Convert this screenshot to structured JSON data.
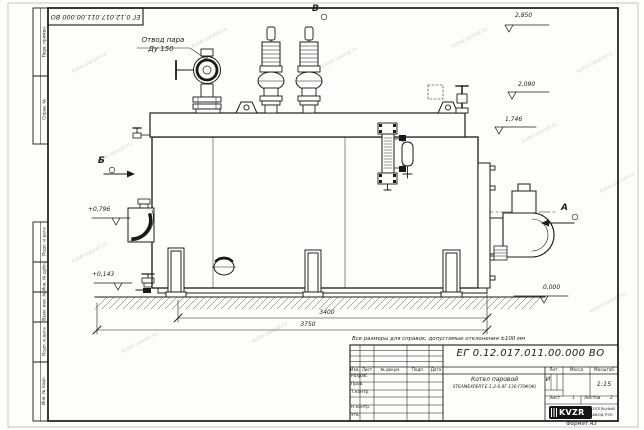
{
  "page": {
    "format": "Формат  А3",
    "watermark": "kotel-zavod.ru"
  },
  "margin": {
    "top_number": "ЕГ 0.12.017.011.00.000  ВО",
    "stamps": [
      "Перв. примен.",
      "Справ. №",
      "Подп. и дата",
      "Инв. № дубл.",
      "Взам. инв. №",
      "Подп. и дата",
      "Инв. № подл."
    ]
  },
  "drawing": {
    "steam_outlet": {
      "line1": "Отвод пара",
      "line2": "Ду 150"
    },
    "views": {
      "b": "Б",
      "v": "В",
      "a": "А"
    },
    "elevations": [
      "2,850",
      "2,090",
      "1,746",
      "+0,796",
      "+0,143",
      "0,000"
    ],
    "dims": [
      "3400",
      "3750"
    ],
    "note": "Все размеры для справок, допустимые отклонения ±100 мм"
  },
  "tb": {
    "doc_number": "ЕГ 0.12.017.011.00.000  ВО",
    "product_line1": "Котел паровой",
    "product_line2": "STEAMEXPERT-Е-1,2-0,9Г-130-ГЛЖ(Ж)",
    "header_cols": [
      "Изм.",
      "Лист",
      "№ докум.",
      "Подп.",
      "Дата"
    ],
    "sign_rows": [
      "Разраб.",
      "Пров.",
      "Т.контр.",
      "Н.контр.",
      "Утв."
    ],
    "lit_label": "Лит.",
    "lit_value": "И",
    "mass_label": "Масса",
    "scale_label": "Масштаб",
    "scale_value": "1:15",
    "sheet_label": "Лист",
    "sheet_value": "1",
    "sheets_label": "Листов",
    "sheets_value": "2",
    "logo_text": "KVZR",
    "company_line1": "КОТЕЛЬНЫЙ",
    "company_line2": "ЗАВОД РЭП"
  }
}
